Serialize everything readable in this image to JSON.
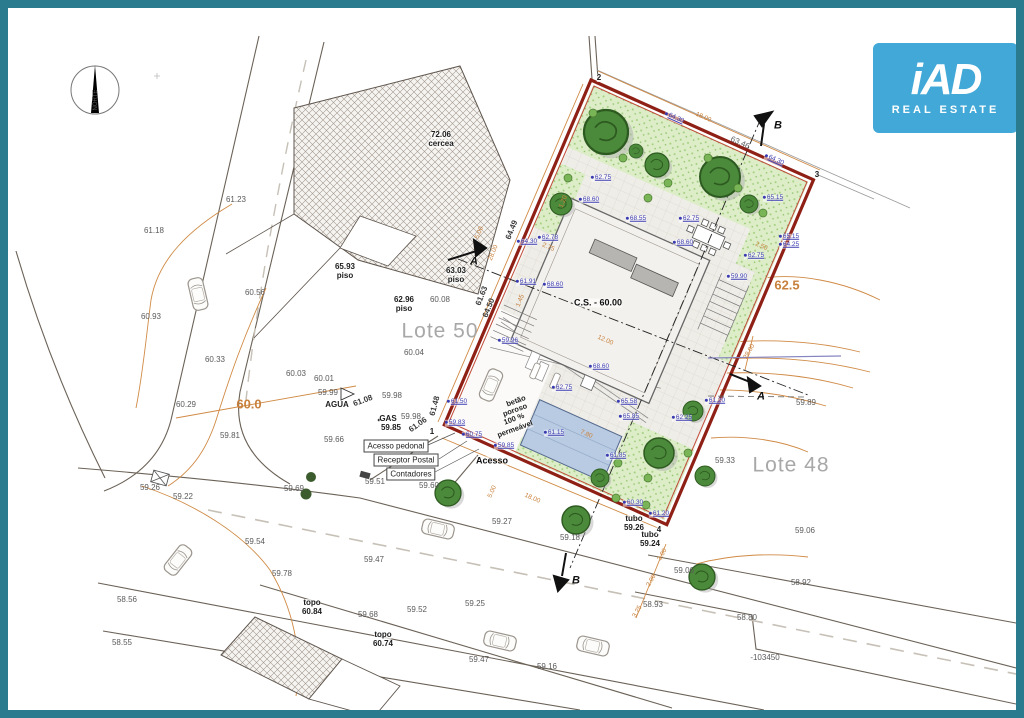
{
  "frame": {
    "border_color": "#2b7b8e"
  },
  "logo": {
    "brand": "iAD",
    "tagline": "REAL ESTATE",
    "bg": "#41a8d7"
  },
  "colors": {
    "boundary_red": "#8f2016",
    "contour_orange": "#d08a45",
    "elev_blue": "#3b3bb0",
    "grass_green": "#dcedc8",
    "tree_green": "#4c8a3b",
    "pool_blue": "#b9cbe2"
  },
  "plan": {
    "labels": [
      {
        "t": "NORTE",
        "x": 88,
        "y": 92,
        "c": "tiny",
        "r": -90
      },
      {
        "t": "61.23",
        "x": 228,
        "y": 192,
        "c": "g"
      },
      {
        "t": "61.18",
        "x": 146,
        "y": 223,
        "c": "g"
      },
      {
        "t": "60.93",
        "x": 143,
        "y": 309,
        "c": "g"
      },
      {
        "t": "60.56",
        "x": 247,
        "y": 285,
        "c": "g"
      },
      {
        "t": "60.33",
        "x": 207,
        "y": 352,
        "c": "g"
      },
      {
        "t": "60.29",
        "x": 178,
        "y": 397,
        "c": "g"
      },
      {
        "t": "60.03",
        "x": 288,
        "y": 366,
        "c": "g"
      },
      {
        "t": "60.01",
        "x": 316,
        "y": 371,
        "c": "g"
      },
      {
        "t": "59.99",
        "x": 320,
        "y": 385,
        "c": "g"
      },
      {
        "t": "60.0",
        "x": 241,
        "y": 396,
        "c": "obig"
      },
      {
        "t": "59.81",
        "x": 222,
        "y": 428,
        "c": "g"
      },
      {
        "t": "59.26",
        "x": 142,
        "y": 480,
        "c": "g"
      },
      {
        "t": "59.22",
        "x": 175,
        "y": 489,
        "c": "g"
      },
      {
        "t": "59.54",
        "x": 247,
        "y": 534,
        "c": "g"
      },
      {
        "t": "59.78",
        "x": 274,
        "y": 566,
        "c": "g"
      },
      {
        "t": "58.56",
        "x": 119,
        "y": 592,
        "c": "g"
      },
      {
        "t": "58.55",
        "x": 114,
        "y": 635,
        "c": "g"
      },
      {
        "t": "topo",
        "x": 304,
        "y": 595,
        "c": "k"
      },
      {
        "t": "60.84",
        "x": 304,
        "y": 604,
        "c": "k"
      },
      {
        "t": "topo",
        "x": 375,
        "y": 627,
        "c": "k"
      },
      {
        "t": "60.74",
        "x": 375,
        "y": 636,
        "c": "k"
      },
      {
        "t": "59.69",
        "x": 286,
        "y": 481,
        "c": "g"
      },
      {
        "t": "59.66",
        "x": 326,
        "y": 432,
        "c": "g"
      },
      {
        "t": "59.51",
        "x": 367,
        "y": 474,
        "c": "g"
      },
      {
        "t": "59.60",
        "x": 421,
        "y": 478,
        "c": "g"
      },
      {
        "t": "59.27",
        "x": 494,
        "y": 514,
        "c": "g"
      },
      {
        "t": "59.18",
        "x": 562,
        "y": 530,
        "c": "g"
      },
      {
        "t": "59.47",
        "x": 366,
        "y": 552,
        "c": "g"
      },
      {
        "t": "59.52",
        "x": 409,
        "y": 602,
        "c": "g"
      },
      {
        "t": "59.25",
        "x": 467,
        "y": 596,
        "c": "g"
      },
      {
        "t": "59.68",
        "x": 360,
        "y": 607,
        "c": "g"
      },
      {
        "t": "59.47",
        "x": 471,
        "y": 652,
        "c": "g"
      },
      {
        "t": "59.16",
        "x": 539,
        "y": 659,
        "c": "g"
      },
      {
        "t": "58.93",
        "x": 645,
        "y": 597,
        "c": "g"
      },
      {
        "t": "58.92",
        "x": 793,
        "y": 575,
        "c": "g"
      },
      {
        "t": "59.06",
        "x": 676,
        "y": 563,
        "c": "g"
      },
      {
        "t": "58.80",
        "x": 739,
        "y": 610,
        "c": "g"
      },
      {
        "t": "-103450",
        "x": 757,
        "y": 650,
        "c": "g"
      },
      {
        "t": "59.06",
        "x": 797,
        "y": 523,
        "c": "g"
      },
      {
        "t": "59.33",
        "x": 717,
        "y": 453,
        "c": "g"
      },
      {
        "t": "59.89",
        "x": 798,
        "y": 395,
        "c": "g"
      },
      {
        "t": "59.98",
        "x": 384,
        "y": 388,
        "c": "g"
      },
      {
        "t": "59.98",
        "x": 403,
        "y": 409,
        "c": "g"
      },
      {
        "t": "60.08",
        "x": 432,
        "y": 292,
        "c": "g"
      },
      {
        "t": "60.04",
        "x": 406,
        "y": 345,
        "c": "g"
      },
      {
        "t": "63.46",
        "x": 732,
        "y": 135,
        "c": "g",
        "r": 24
      },
      {
        "t": "Lote 50",
        "x": 432,
        "y": 323,
        "c": "lot"
      },
      {
        "t": "Lote 48",
        "x": 783,
        "y": 457,
        "c": "lot"
      },
      {
        "t": "72.06",
        "x": 433,
        "y": 127,
        "c": "k"
      },
      {
        "t": "cercea",
        "x": 433,
        "y": 136,
        "c": "k"
      },
      {
        "t": "65.93",
        "x": 337,
        "y": 259,
        "c": "k"
      },
      {
        "t": "piso",
        "x": 337,
        "y": 268,
        "c": "k"
      },
      {
        "t": "63.03",
        "x": 448,
        "y": 263,
        "c": "k"
      },
      {
        "t": "piso",
        "x": 448,
        "y": 272,
        "c": "k"
      },
      {
        "t": "62.96",
        "x": 396,
        "y": 292,
        "c": "k"
      },
      {
        "t": "piso",
        "x": 396,
        "y": 301,
        "c": "k"
      },
      {
        "t": "C.S. - 60.00",
        "x": 590,
        "y": 295,
        "c": "k9"
      },
      {
        "t": "AGUA",
        "x": 329,
        "y": 397,
        "c": "k"
      },
      {
        "t": "GAS",
        "x": 380,
        "y": 411,
        "c": "k"
      },
      {
        "t": "59.85",
        "x": 383,
        "y": 420,
        "c": "k"
      },
      {
        "t": "tubo",
        "x": 626,
        "y": 511,
        "c": "k"
      },
      {
        "t": "59.26",
        "x": 626,
        "y": 520,
        "c": "k"
      },
      {
        "t": "tubo",
        "x": 642,
        "y": 527,
        "c": "k"
      },
      {
        "t": "59.24",
        "x": 642,
        "y": 536,
        "c": "k"
      },
      {
        "t": "Acesso",
        "x": 484,
        "y": 453,
        "c": "k9"
      },
      {
        "t": "betão",
        "x": 508,
        "y": 393,
        "c": "sm",
        "r": -20
      },
      {
        "t": "poroso",
        "x": 507,
        "y": 402,
        "c": "sm",
        "r": -20
      },
      {
        "t": "100 %",
        "x": 506,
        "y": 411,
        "c": "sm",
        "r": -20
      },
      {
        "t": "permeável",
        "x": 507,
        "y": 421,
        "c": "sm",
        "r": -20
      },
      {
        "t": "2",
        "x": 591,
        "y": 70,
        "c": "k"
      },
      {
        "t": "3",
        "x": 809,
        "y": 167,
        "c": "k"
      },
      {
        "t": "4",
        "x": 651,
        "y": 522,
        "c": "k"
      },
      {
        "t": "1",
        "x": 424,
        "y": 424,
        "c": "k"
      },
      {
        "t": "A",
        "x": 466,
        "y": 254,
        "c": "A"
      },
      {
        "t": "A",
        "x": 753,
        "y": 389,
        "c": "A"
      },
      {
        "t": "B",
        "x": 770,
        "y": 118,
        "c": "A"
      },
      {
        "t": "B",
        "x": 568,
        "y": 573,
        "c": "A"
      },
      {
        "t": "Acesso pedonal",
        "x": 388,
        "y": 438,
        "c": "x"
      },
      {
        "t": "Receptor Postal",
        "x": 398,
        "y": 452,
        "c": "x"
      },
      {
        "t": "Contadores",
        "x": 403,
        "y": 466,
        "c": "x"
      },
      {
        "t": "18.00",
        "x": 695,
        "y": 110,
        "c": "o",
        "r": 24
      },
      {
        "t": "64.30",
        "x": 666,
        "y": 110,
        "c": "b",
        "r": 24
      },
      {
        "t": "64.30",
        "x": 766,
        "y": 152,
        "c": "b",
        "r": 24
      },
      {
        "t": "64.30",
        "x": 519,
        "y": 234,
        "c": "b"
      },
      {
        "t": "62.75",
        "x": 593,
        "y": 170,
        "c": "b"
      },
      {
        "t": "68.60",
        "x": 581,
        "y": 192,
        "c": "b"
      },
      {
        "t": "68.55",
        "x": 628,
        "y": 211,
        "c": "b"
      },
      {
        "t": "62.75",
        "x": 681,
        "y": 211,
        "c": "b"
      },
      {
        "t": "68.60",
        "x": 675,
        "y": 235,
        "c": "b"
      },
      {
        "t": "62.78",
        "x": 540,
        "y": 230,
        "c": "b"
      },
      {
        "t": "65.15",
        "x": 765,
        "y": 190,
        "c": "b"
      },
      {
        "t": "65.15",
        "x": 781,
        "y": 229,
        "c": "b"
      },
      {
        "t": "64.25",
        "x": 781,
        "y": 237,
        "c": "b"
      },
      {
        "t": "62.75",
        "x": 746,
        "y": 248,
        "c": "b"
      },
      {
        "t": "62.75",
        "x": 554,
        "y": 380,
        "c": "b"
      },
      {
        "t": "61.91",
        "x": 518,
        "y": 274,
        "c": "b"
      },
      {
        "t": "68.60",
        "x": 545,
        "y": 277,
        "c": "b"
      },
      {
        "t": "59.96",
        "x": 500,
        "y": 333,
        "c": "b"
      },
      {
        "t": "68.60",
        "x": 591,
        "y": 359,
        "c": "b"
      },
      {
        "t": "65.58",
        "x": 619,
        "y": 394,
        "c": "b"
      },
      {
        "t": "65.85",
        "x": 621,
        "y": 409,
        "c": "b"
      },
      {
        "t": "59.90",
        "x": 729,
        "y": 269,
        "c": "b"
      },
      {
        "t": "61.50",
        "x": 449,
        "y": 394,
        "c": "b"
      },
      {
        "t": "59.83",
        "x": 447,
        "y": 415,
        "c": "b"
      },
      {
        "t": "60.75",
        "x": 464,
        "y": 427,
        "c": "b"
      },
      {
        "t": "59.85",
        "x": 496,
        "y": 438,
        "c": "b"
      },
      {
        "t": "61.15",
        "x": 546,
        "y": 425,
        "c": "b"
      },
      {
        "t": "61.85",
        "x": 608,
        "y": 448,
        "c": "b"
      },
      {
        "t": "60.30",
        "x": 625,
        "y": 495,
        "c": "b"
      },
      {
        "t": "61.20",
        "x": 651,
        "y": 506,
        "c": "b"
      },
      {
        "t": "61.20",
        "x": 707,
        "y": 393,
        "c": "b"
      },
      {
        "t": "62.25",
        "x": 674,
        "y": 410,
        "c": "b"
      },
      {
        "t": "64.49",
        "x": 504,
        "y": 222,
        "c": "gb",
        "r": -68
      },
      {
        "t": "64.50",
        "x": 481,
        "y": 300,
        "c": "gb",
        "r": -68
      },
      {
        "t": "61.63",
        "x": 474,
        "y": 288,
        "c": "gb",
        "r": -68
      },
      {
        "t": "61.48",
        "x": 427,
        "y": 398,
        "c": "gb",
        "r": -75
      },
      {
        "t": "61.08",
        "x": 355,
        "y": 393,
        "c": "gb",
        "r": -20
      },
      {
        "t": "61.06",
        "x": 410,
        "y": 417,
        "c": "gb",
        "r": -35
      },
      {
        "t": "5.00",
        "x": 472,
        "y": 225,
        "c": "o",
        "r": -68
      },
      {
        "t": "28.00",
        "x": 486,
        "y": 245,
        "c": "o",
        "r": -68
      },
      {
        "t": "2.75",
        "x": 540,
        "y": 240,
        "c": "o",
        "r": 24
      },
      {
        "t": "1.45",
        "x": 513,
        "y": 293,
        "c": "o",
        "r": -68
      },
      {
        "t": "1.20",
        "x": 556,
        "y": 194,
        "c": "o",
        "r": -68
      },
      {
        "t": "12.00",
        "x": 597,
        "y": 333,
        "c": "o",
        "r": 24
      },
      {
        "t": "7.80",
        "x": 578,
        "y": 427,
        "c": "o",
        "r": 24
      },
      {
        "t": "2.50",
        "x": 753,
        "y": 239,
        "c": "o",
        "r": 24
      },
      {
        "t": "5.00",
        "x": 485,
        "y": 484,
        "c": "o",
        "r": -66
      },
      {
        "t": "18.00",
        "x": 524,
        "y": 491,
        "c": "o",
        "r": 24
      },
      {
        "t": "28.00",
        "x": 742,
        "y": 344,
        "c": "o",
        "r": -60
      },
      {
        "t": "3.00",
        "x": 655,
        "y": 547,
        "c": "o",
        "r": -60
      },
      {
        "t": "2.00",
        "x": 644,
        "y": 573,
        "c": "o",
        "r": -60
      },
      {
        "t": "3.25",
        "x": 630,
        "y": 604,
        "c": "o",
        "r": -60
      },
      {
        "t": "62.5",
        "x": 779,
        "y": 277,
        "c": "obig"
      }
    ]
  }
}
